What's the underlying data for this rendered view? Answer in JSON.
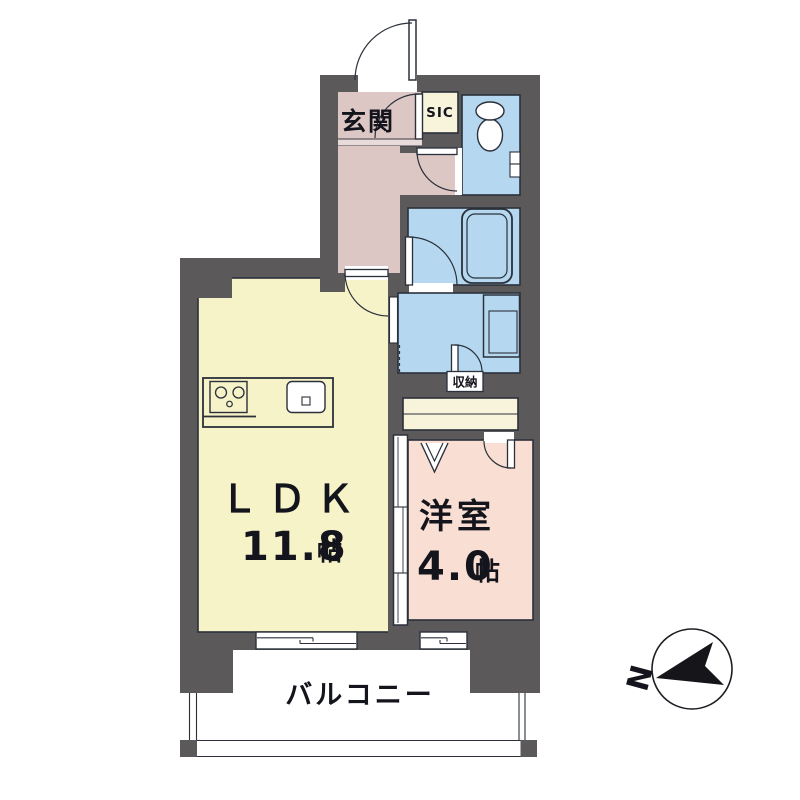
{
  "floorplan": {
    "rooms": {
      "entrance": {
        "label": "玄関"
      },
      "shoe_closet": {
        "label": "SIC"
      },
      "storage": {
        "label": "収納"
      },
      "ldk": {
        "label": "ＬＤＫ",
        "size_value": "11.8",
        "size_unit": "帖"
      },
      "western_room": {
        "label": "洋室",
        "size_value": "4.0",
        "size_unit": "帖"
      },
      "balcony": {
        "label": "バルコニー"
      }
    },
    "compass": {
      "north_label": "N"
    },
    "colors": {
      "wall": "#5c595b",
      "entrance_hall": "#dcc7c5",
      "closet_cream": "#f8f4dc",
      "water_rooms_blue": "#b5d8f0",
      "ldk_yellow": "#f6f3c8",
      "western_room_pink": "#f9dfd3",
      "outline": "#2b303a"
    }
  }
}
